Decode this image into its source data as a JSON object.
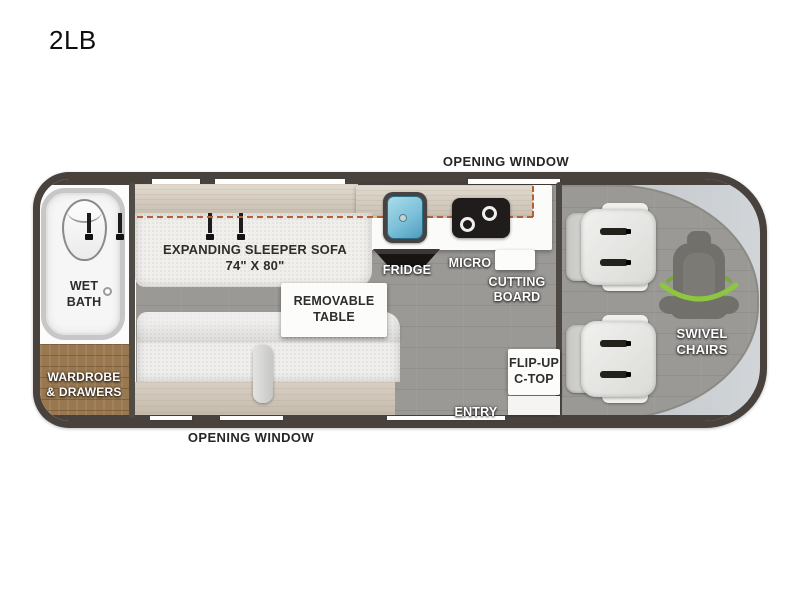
{
  "page_title": "2LB",
  "floorplan": {
    "windows": {
      "top": "OPENING WINDOW",
      "bottom": "OPENING WINDOW"
    },
    "areas": {
      "wet_bath": "WET\nBATH",
      "wardrobe": "WARDROBE\n& DRAWERS",
      "sleeper_sofa": "EXPANDING SLEEPER SOFA\n74\" X 80\"",
      "removable_table": "REMOVABLE\nTABLE",
      "fridge": "FRIDGE",
      "micro": "MICRO",
      "cutting_board": "CUTTING\nBOARD",
      "flip_up_ctop": "FLIP-UP\nC-TOP",
      "entry": "ENTRY",
      "swivel_chairs": "SWIVEL\nCHAIRS"
    },
    "colors": {
      "body_outline": "#48413c",
      "floor_gray": "#9b9996",
      "cabinet_wood": "#d7cdbe",
      "wardrobe_wood": "#997850",
      "windshield_band": "#c9ced2",
      "dashed_bed_line": "#b26038",
      "swivel_arrow_green": "#8dc63f",
      "sink_blue": "#7cc0d9"
    }
  }
}
